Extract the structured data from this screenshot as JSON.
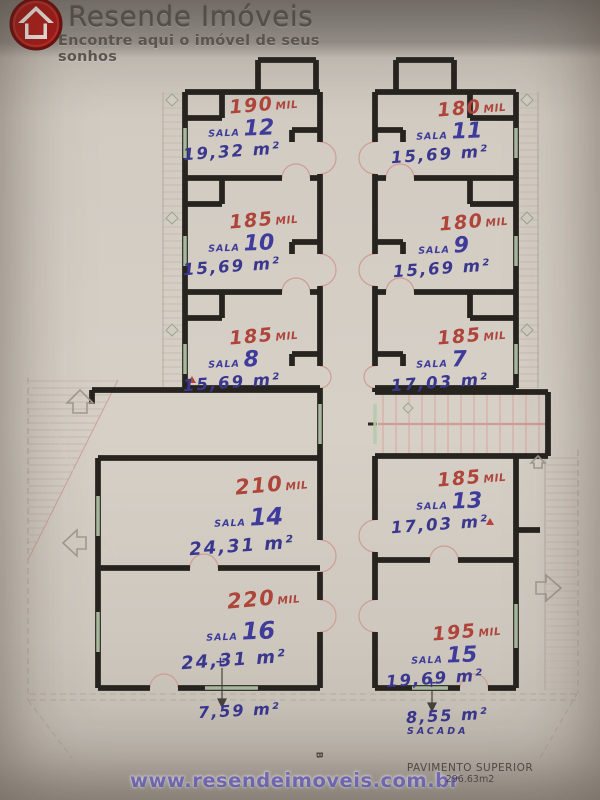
{
  "header": {
    "brand": "Resende Imóveis",
    "tagline": "Encontre aqui o imóvel de seus sonhos"
  },
  "colors": {
    "logo_red": "#b3201d",
    "price_red": "#ae443a",
    "ink_blue": "#3e3b9b",
    "url_purple": "#837ae0",
    "wall_black": "#272420",
    "paper": "#d2ccc3"
  },
  "rooms": [
    {
      "label_prefix": "SALA",
      "number": "12",
      "price": "190",
      "price_suffix": "MIL",
      "area": "19,32 m²"
    },
    {
      "label_prefix": "SALA",
      "number": "11",
      "price": "180",
      "price_suffix": "MIL",
      "area": "15,69 m²"
    },
    {
      "label_prefix": "SALA",
      "number": "10",
      "price": "185",
      "price_suffix": "MIL",
      "area": "15,69 m²"
    },
    {
      "label_prefix": "SALA",
      "number": "9",
      "price": "180",
      "price_suffix": "MIL",
      "area": "15,69 m²"
    },
    {
      "label_prefix": "SALA",
      "number": "8",
      "price": "185",
      "price_suffix": "MIL",
      "area": "15,69 m²"
    },
    {
      "label_prefix": "SALA",
      "number": "7",
      "price": "185",
      "price_suffix": "MIL",
      "area": "17,03 m²"
    },
    {
      "label_prefix": "SALA",
      "number": "14",
      "price": "210",
      "price_suffix": "MIL",
      "area": "24,31 m²"
    },
    {
      "label_prefix": "SALA",
      "number": "13",
      "price": "185",
      "price_suffix": "MIL",
      "area": "17,03 m²"
    },
    {
      "label_prefix": "SALA",
      "number": "16",
      "price": "220",
      "price_suffix": "MIL",
      "area": "24,31 m²"
    },
    {
      "label_prefix": "SALA",
      "number": "15",
      "price": "195",
      "price_suffix": "MIL",
      "area": "19,69 m²"
    }
  ],
  "annotations": {
    "left": {
      "plus": "+",
      "area": "7,59 m²"
    },
    "right": {
      "plus": "+",
      "area": "8,55 m²",
      "label": "SACADA"
    },
    "marker_b": "B"
  },
  "footer": {
    "url": "www.resendeimoveis.com.br",
    "plan_title": "PAVIMENTO SUPERIOR",
    "plan_area": "296.63m2"
  }
}
